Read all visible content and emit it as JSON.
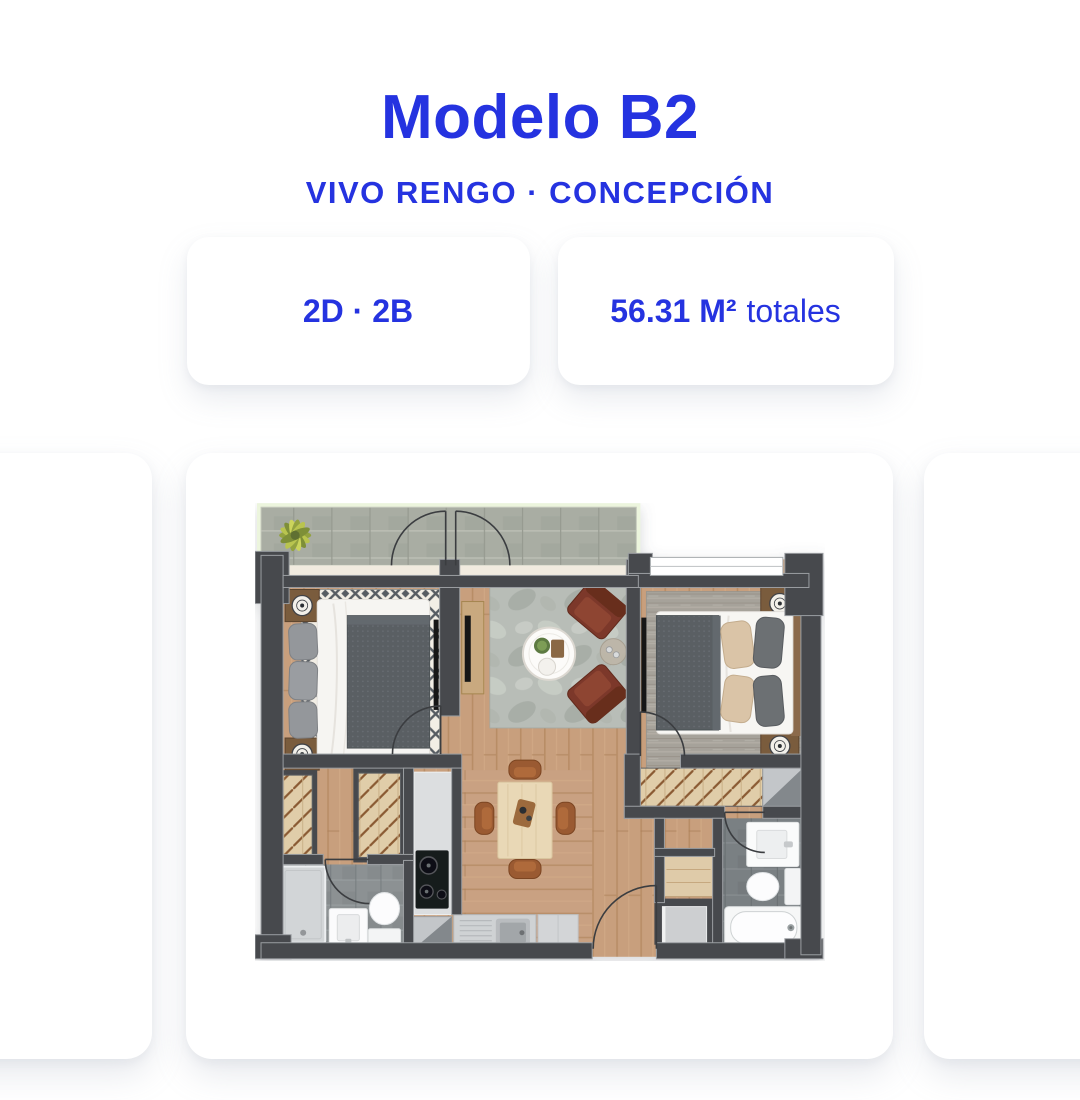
{
  "header": {
    "title": "Modelo B2",
    "subtitle": "VIVO RENGO · CONCEPCIÓN"
  },
  "badges": [
    {
      "id": "typology",
      "text": "2D · 2B"
    },
    {
      "id": "area",
      "value": "56.31 M²",
      "suffix": "totales"
    }
  ],
  "carousel": {
    "cards_visible": 3,
    "active_slide": "floor-plan"
  },
  "floor_plan": {
    "view": "top-down-apartment-render",
    "rooms": [
      "balcony",
      "bedroom-1",
      "living-room",
      "bedroom-2",
      "hallway",
      "kitchen",
      "dining-area",
      "bathroom-1",
      "bathroom-2",
      "wardrobe-closets",
      "laundry-storage"
    ],
    "icon_names": [
      "plant-icon",
      "double-bed-icon",
      "armchair-icon",
      "coffee-table-icon",
      "tv-icon",
      "dining-table-icon",
      "cooktop-icon",
      "kitchen-sink-icon",
      "shower-icon",
      "toilet-icon",
      "bathtub-icon",
      "washbasin-icon",
      "door-swing-icon",
      "wardrobe-hatch-icon"
    ]
  },
  "colors": {
    "accent_blue": "#2533e0",
    "card_bg": "#ffffff",
    "wall": "#474a4e",
    "wood_floor": "#c89f7d",
    "bath_tile": "#8c9193",
    "armchair_brown": "#7c392a"
  }
}
